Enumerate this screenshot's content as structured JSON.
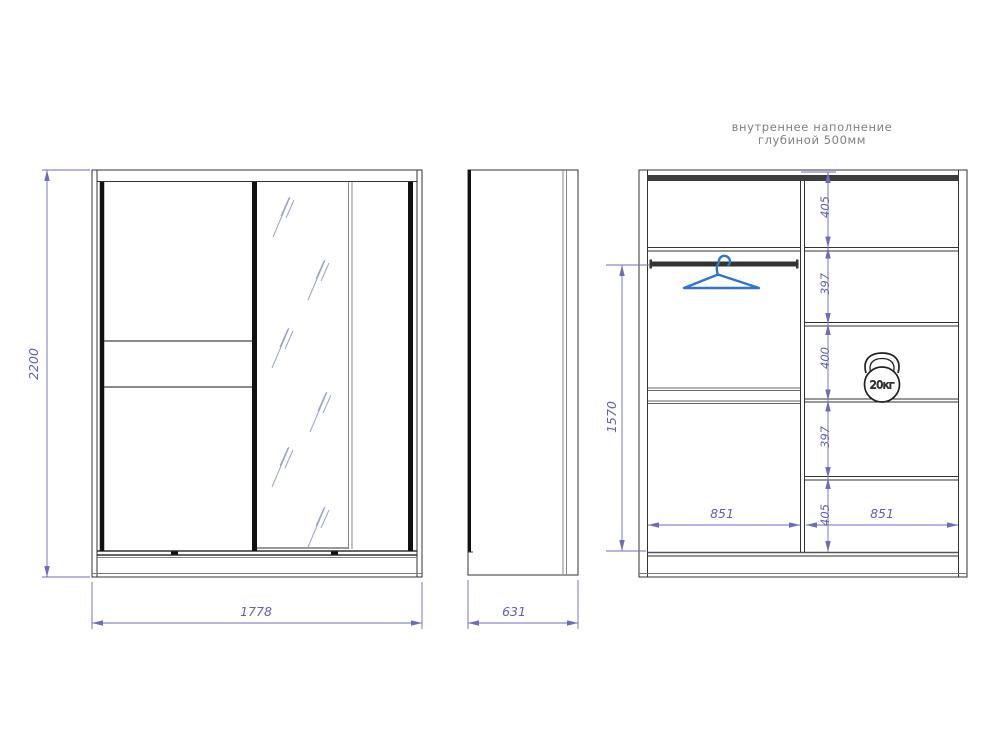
{
  "header": {
    "line1": "внутреннее наполнение",
    "line2": "глубиной 500мм"
  },
  "front_view": {
    "height_mm": "2200",
    "width_mm": "1778"
  },
  "side_view": {
    "depth_mm": "631"
  },
  "internal_view": {
    "rod_height_mm": "1570",
    "section_gaps_mm": [
      "405",
      "397",
      "400",
      "397",
      "405"
    ],
    "left_section_width_mm": "851",
    "right_section_width_mm": "851",
    "weight_limit": "20кг"
  },
  "colors": {
    "outline": "#333333",
    "thick_profile": "#111111",
    "dimension": "#6b6bbf",
    "dimension_text": "#5f5fbe",
    "hanger_blue": "#2e75cc",
    "annotation_gray": "#7f7f7f",
    "mirror_glare": "#9aa3cc"
  }
}
